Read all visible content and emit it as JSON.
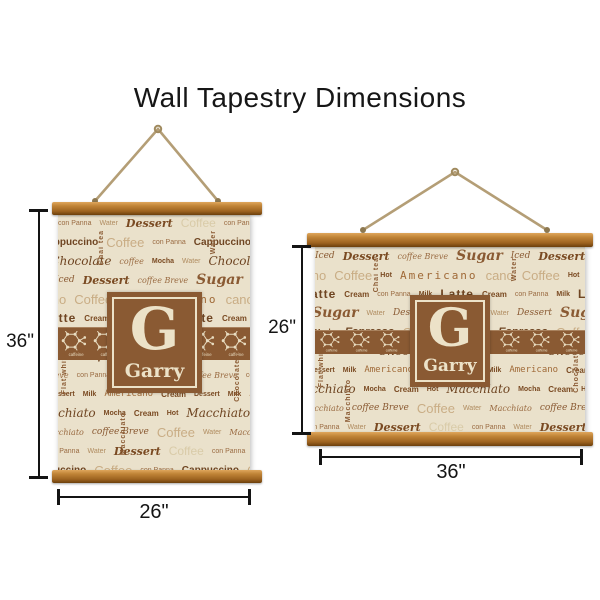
{
  "title": "Wall Tapestry Dimensions",
  "monogram": {
    "initial": "G",
    "name": "Garry"
  },
  "tapestries": {
    "portrait": {
      "height_label": "36\"",
      "width_label": "26\""
    },
    "landscape": {
      "height_label": "26\"",
      "width_label": "36\""
    }
  },
  "pattern": {
    "molecule_label": "caffeine",
    "vertical_words": [
      "Flat white",
      "Chai tea",
      "Water",
      "Chocolates",
      "Macchiato",
      "con Panna"
    ],
    "rows": [
      [
        {
          "t": "con Panna",
          "s": "sm"
        },
        {
          "t": "Water",
          "s": "sm2"
        },
        {
          "t": "Dessert",
          "s": "script-b"
        },
        {
          "t": "Coffee",
          "s": "ghost"
        }
      ],
      [
        {
          "t": "Cappuccino",
          "s": "bold"
        },
        {
          "t": "Coffee",
          "s": "light-lg"
        },
        {
          "t": "con Panna",
          "s": "sm"
        }
      ],
      [
        {
          "t": "Water",
          "s": "sm2"
        },
        {
          "t": "Chocolate",
          "s": "script-lg"
        },
        {
          "t": "coffee",
          "s": "it-sm"
        },
        {
          "t": "Mocha",
          "s": "tiny-b"
        }
      ],
      [
        {
          "t": "Iced",
          "s": "script-sm"
        },
        {
          "t": "Dessert",
          "s": "script-b"
        },
        {
          "t": "coffee Breve",
          "s": "it-sm"
        },
        {
          "t": "Sugar",
          "s": "script-xl"
        }
      ],
      [
        {
          "t": "cano",
          "s": "light-lg"
        },
        {
          "t": "Coffee",
          "s": "light-lg"
        },
        {
          "t": "Hot",
          "s": "tiny-b"
        },
        {
          "t": "Americano",
          "s": "mono-lg"
        }
      ],
      [
        {
          "t": "Milk",
          "s": "tiny-b"
        },
        {
          "t": "Latte",
          "s": "bold-lg"
        },
        {
          "t": "Cream",
          "s": "bold-sm"
        },
        {
          "t": "con Panna",
          "s": "sm"
        }
      ],
      [
        {
          "t": "Sugar",
          "s": "script-xl"
        },
        {
          "t": "Water",
          "s": "sm2"
        },
        {
          "t": "Dessert",
          "s": "script-sm"
        }
      ],
      [
        {
          "t": "Hot",
          "s": "tiny-b"
        },
        {
          "t": "Mocha",
          "s": "tiny-b"
        },
        {
          "t": "Espresso",
          "s": "bold-it"
        },
        {
          "t": "Coffee",
          "s": "light-lg"
        }
      ],
      [
        {
          "t": "coffee Breve",
          "s": "it-sm"
        },
        {
          "t": "con Panna",
          "s": "sm"
        },
        {
          "t": "Chocolate",
          "s": "script-lg"
        }
      ],
      [
        {
          "t": "Dessert",
          "s": "tiny-b"
        },
        {
          "t": "Milk",
          "s": "tiny-b"
        },
        {
          "t": "Americano",
          "s": "mono"
        },
        {
          "t": "Cream",
          "s": "bold-sm"
        }
      ],
      [
        {
          "t": "Macchiato",
          "s": "script-lg"
        },
        {
          "t": "Mocha",
          "s": "tiny-b"
        },
        {
          "t": "Cream",
          "s": "bold-sm"
        },
        {
          "t": "Hot",
          "s": "tiny-b"
        }
      ],
      [
        {
          "t": "Water",
          "s": "sm2"
        },
        {
          "t": "Macchiato",
          "s": "it-sm"
        },
        {
          "t": "coffee Breve",
          "s": "script-sm"
        },
        {
          "t": "Coffee",
          "s": "light-lg"
        }
      ]
    ]
  },
  "colors": {
    "wood": "#b57a2e",
    "fabric": "#eae1cb",
    "accent_brown": "#8a5a33",
    "cream": "#ece2c8",
    "rope": "#b49e76",
    "measure": "#141414"
  }
}
